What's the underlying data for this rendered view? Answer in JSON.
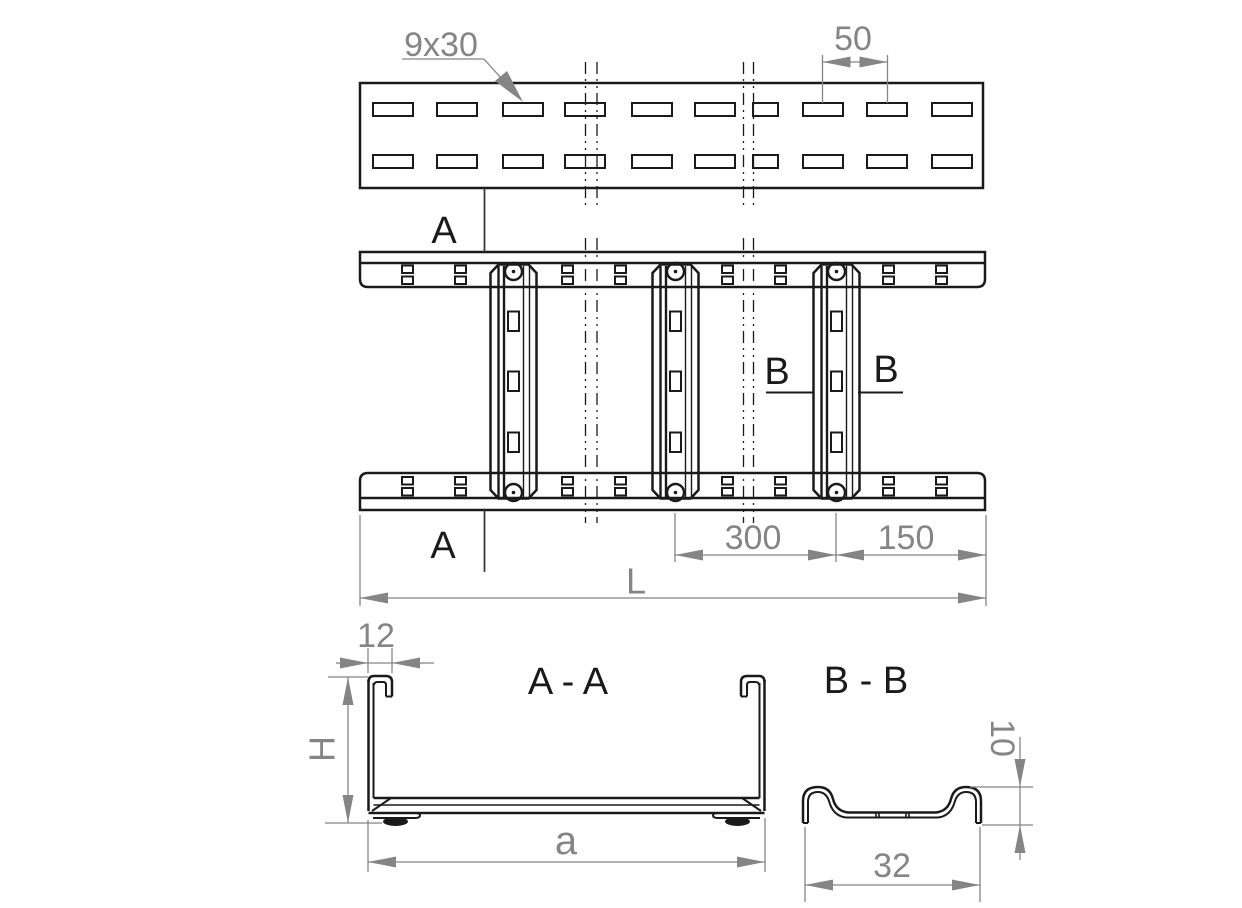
{
  "drawing": {
    "top_view": {
      "slot_size_label": "9x30",
      "slot_pitch_dim": "50"
    },
    "plan_view": {
      "cut_a_top": "A",
      "cut_a_bottom": "A",
      "cut_b_left": "B",
      "cut_b_right": "B",
      "dim_rung_spacing": "300",
      "dim_end_distance": "150",
      "dim_total_length": "L"
    },
    "section_aa": {
      "title": "A - A",
      "dim_lip_width": "12",
      "dim_height": "H",
      "dim_inner_width": "a"
    },
    "section_bb": {
      "title": "B - B",
      "dim_profile_height": "10",
      "dim_profile_width": "32"
    },
    "colors": {
      "line": "#1a1a1a",
      "dimension": "#858585",
      "background": "#ffffff"
    }
  }
}
